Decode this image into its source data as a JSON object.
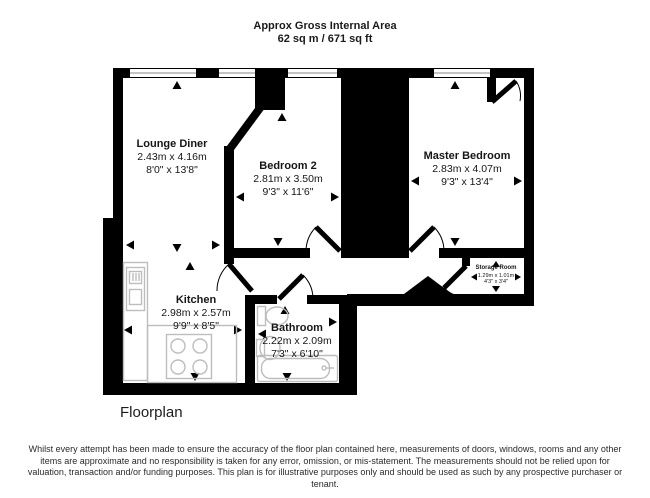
{
  "colors": {
    "wall": "#000000",
    "fixture_outline": "#bdbdbd",
    "window_line": "#8a8a8a"
  },
  "header": {
    "line1": "Approx Gross Internal Area",
    "line2": "62 sq m / 671 sq ft"
  },
  "rooms": [
    {
      "name": "Lounge Diner",
      "metric": "2.43m x 4.16m",
      "imperial": "8'0\" x 13'8\""
    },
    {
      "name": "Bedroom 2",
      "metric": "2.81m x 3.50m",
      "imperial": "9'3\" x 11'6\""
    },
    {
      "name": "Master Bedroom",
      "metric": "2.83m x 4.07m",
      "imperial": "9'3\" x 13'4\""
    },
    {
      "name": "Kitchen",
      "metric": "2.98m x 2.57m",
      "imperial": "9'9\" x 8'5\""
    },
    {
      "name": "Bathroom",
      "metric": "2.22m x 2.09m",
      "imperial": "7'3\" x 6'10\""
    },
    {
      "name": "Storage Room",
      "metric": "1.29m x 1.01m",
      "imperial": "4'3\" x 3'4\""
    }
  ],
  "footer": {
    "caption": "Floorplan",
    "disclaimer": "Whilst every attempt has been made to ensure the accuracy of the floor plan contained here, measurements of doors, windows, rooms and any other items are approximate and no responsibility is taken for any error, omission, or mis-statement. The measurements should not be relied upon for valuation, transaction and/or funding purposes. This plan is for illustrative purposes only and should be used as such by any prospective purchaser or tenant."
  }
}
